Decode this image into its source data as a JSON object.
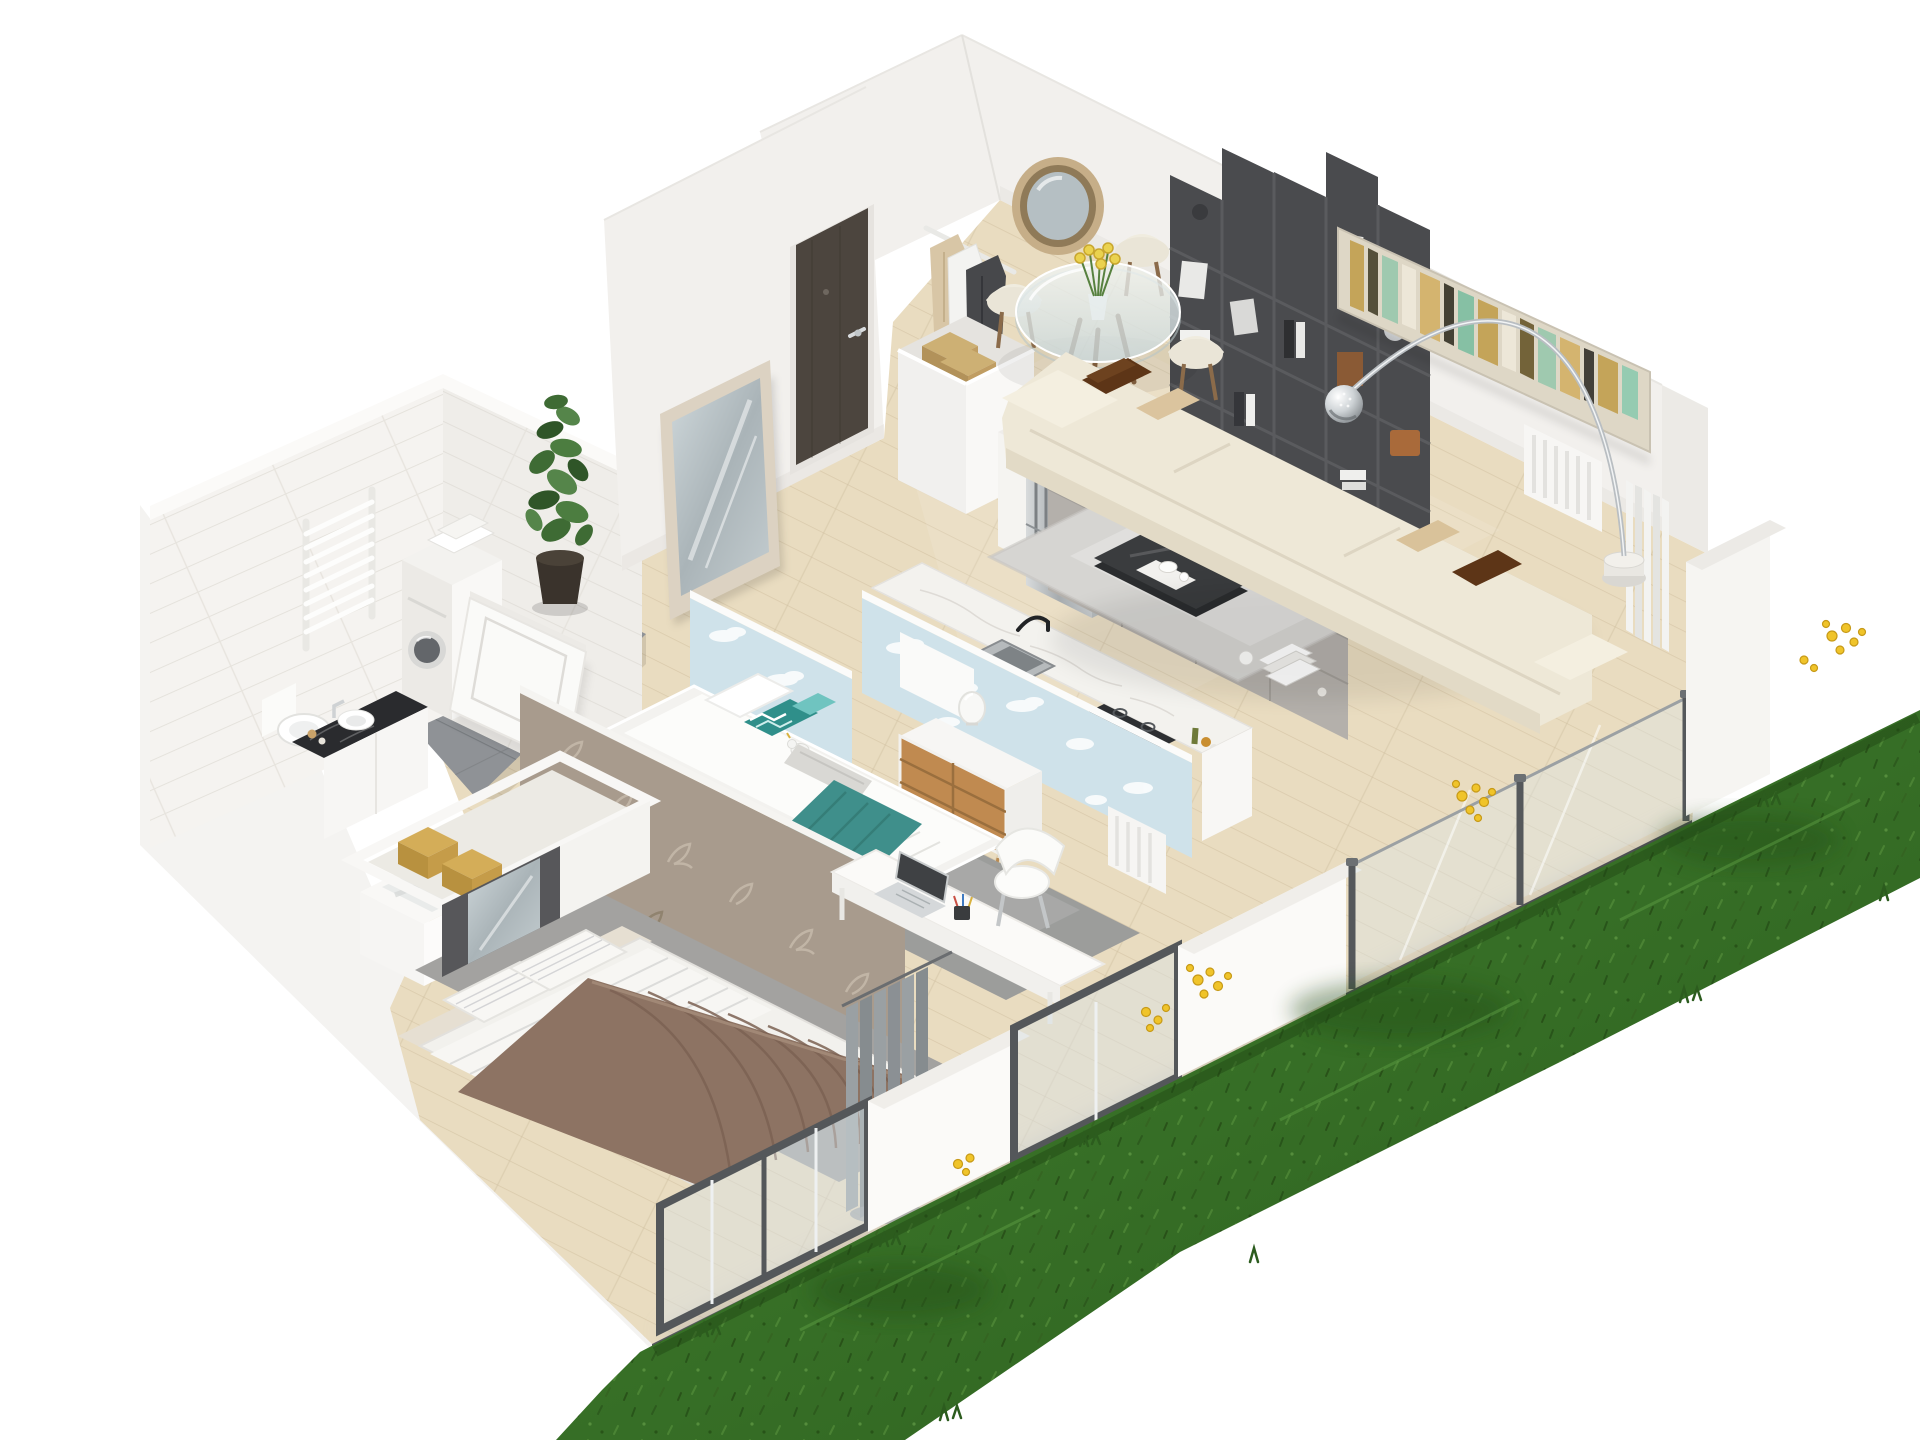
{
  "scene": {
    "title": "Isometric 3D cutaway floor plan rendering of a one-bedroom apartment with a grass garden strip",
    "view": "axonometric from above, white background, walls cut open",
    "canvas": {
      "width": 1920,
      "height": 1440
    },
    "rooms": [
      {
        "name": "entry-hall",
        "floor": "light oak planks",
        "items": [
          "entry-door",
          "leaning-mirror",
          "coat-rack-with-clothes",
          "shoe-cabinet-with-boxes",
          "potted-plant"
        ]
      },
      {
        "name": "dining-area",
        "floor": "light oak planks",
        "items": [
          "round-glass-table",
          "cream-chair-x4",
          "yellow-tulips-vase",
          "round-rope-mirror"
        ]
      },
      {
        "name": "living-room",
        "floor": "light oak planks",
        "items": [
          "cube-bookshelf-with-books",
          "abstract-painting",
          "wall-radiator",
          "cream-sofa",
          "brown-pillows",
          "beige-pillows",
          "arc-floor-lamp",
          "shaggy-rug",
          "dark-glass-coffee-table",
          "book-stack",
          "glass-balustrade",
          "corner-curtain"
        ]
      },
      {
        "name": "kitchen",
        "floor": "light oak planks",
        "items": [
          "tall-white-cabinet",
          "stainless-fridge",
          "marble-island",
          "tv-panel",
          "fruit-bowl",
          "cutting-board",
          "utensil-cup",
          "sink-counter",
          "black-faucet",
          "induction-cooktop",
          "oil-bottles"
        ]
      },
      {
        "name": "kids-room",
        "floor": "light oak planks",
        "items": [
          "cloud-wallpaper-partition-x2",
          "white-pin-board",
          "single-bed",
          "chevron-pillow",
          "teal-cushion",
          "plush-toy",
          "rolled-blanket",
          "teal-throw",
          "gray-rug",
          "desk",
          "laptop",
          "pen-cup",
          "white-chair",
          "dresser-wood-drawers",
          "glass-table-lamp",
          "radiator-panel"
        ]
      },
      {
        "name": "master-bedroom",
        "floor": "light oak planks",
        "items": [
          "leaf-pattern-partition",
          "open-wardrobe",
          "gold-storage-boxes",
          "mirror-sliding-door",
          "double-bed",
          "striped-pillows",
          "striped-duvet",
          "taupe-quilt",
          "gray-rug",
          "gray-curtains",
          "window-wall"
        ]
      },
      {
        "name": "bathroom",
        "floor": "gray large-format tiles",
        "items": [
          "marble-subway-tile-walls",
          "towel-rad radiator",
          "washing-machine",
          "folded-towels",
          "toilet",
          "dark-marble-vanity",
          "vessel-sink",
          "chrome-faucet",
          "soap-bottles",
          "bathtub",
          "open-white-door"
        ]
      },
      {
        "name": "garden",
        "floor": "grass",
        "items": [
          "diagonal-grass-strip",
          "dandelion-flower-clusters",
          "grass-tufts"
        ]
      }
    ]
  },
  "palette": {
    "background": "#ffffff",
    "wallFace": "#f2f0ed",
    "wood": "#e9dcc0",
    "tileWall": "#f5f3f0",
    "bathFloor": "#8f9296",
    "blueWall": "#cfe2ea",
    "leafWall": "#a89b8d",
    "marble": "#f3f2ee",
    "cabinetGray": "#b4b0ab",
    "sofaCream": "#eee8d7",
    "rugLight": "#d6d5d2",
    "rugGray": "#a3a2a0",
    "kidRug": "#9c9d9b",
    "grassGreen": "#3c7a2b",
    "grassDark": "#2d5f20",
    "flowerYellow": "#f0c42a",
    "doorBrown": "#4c453e",
    "bookshelfGray": "#4a4b4e",
    "tvPanel": "#3c3e41",
    "quiltTaupe": "#8d7363",
    "tealThrow": "#3f8f8b",
    "pillowBrown": "#5d3517",
    "frameGray": "#54575a",
    "steel": "#aeb3b5",
    "paintingGold": "#c2a050",
    "paintingMint": "#9ac8ae"
  }
}
